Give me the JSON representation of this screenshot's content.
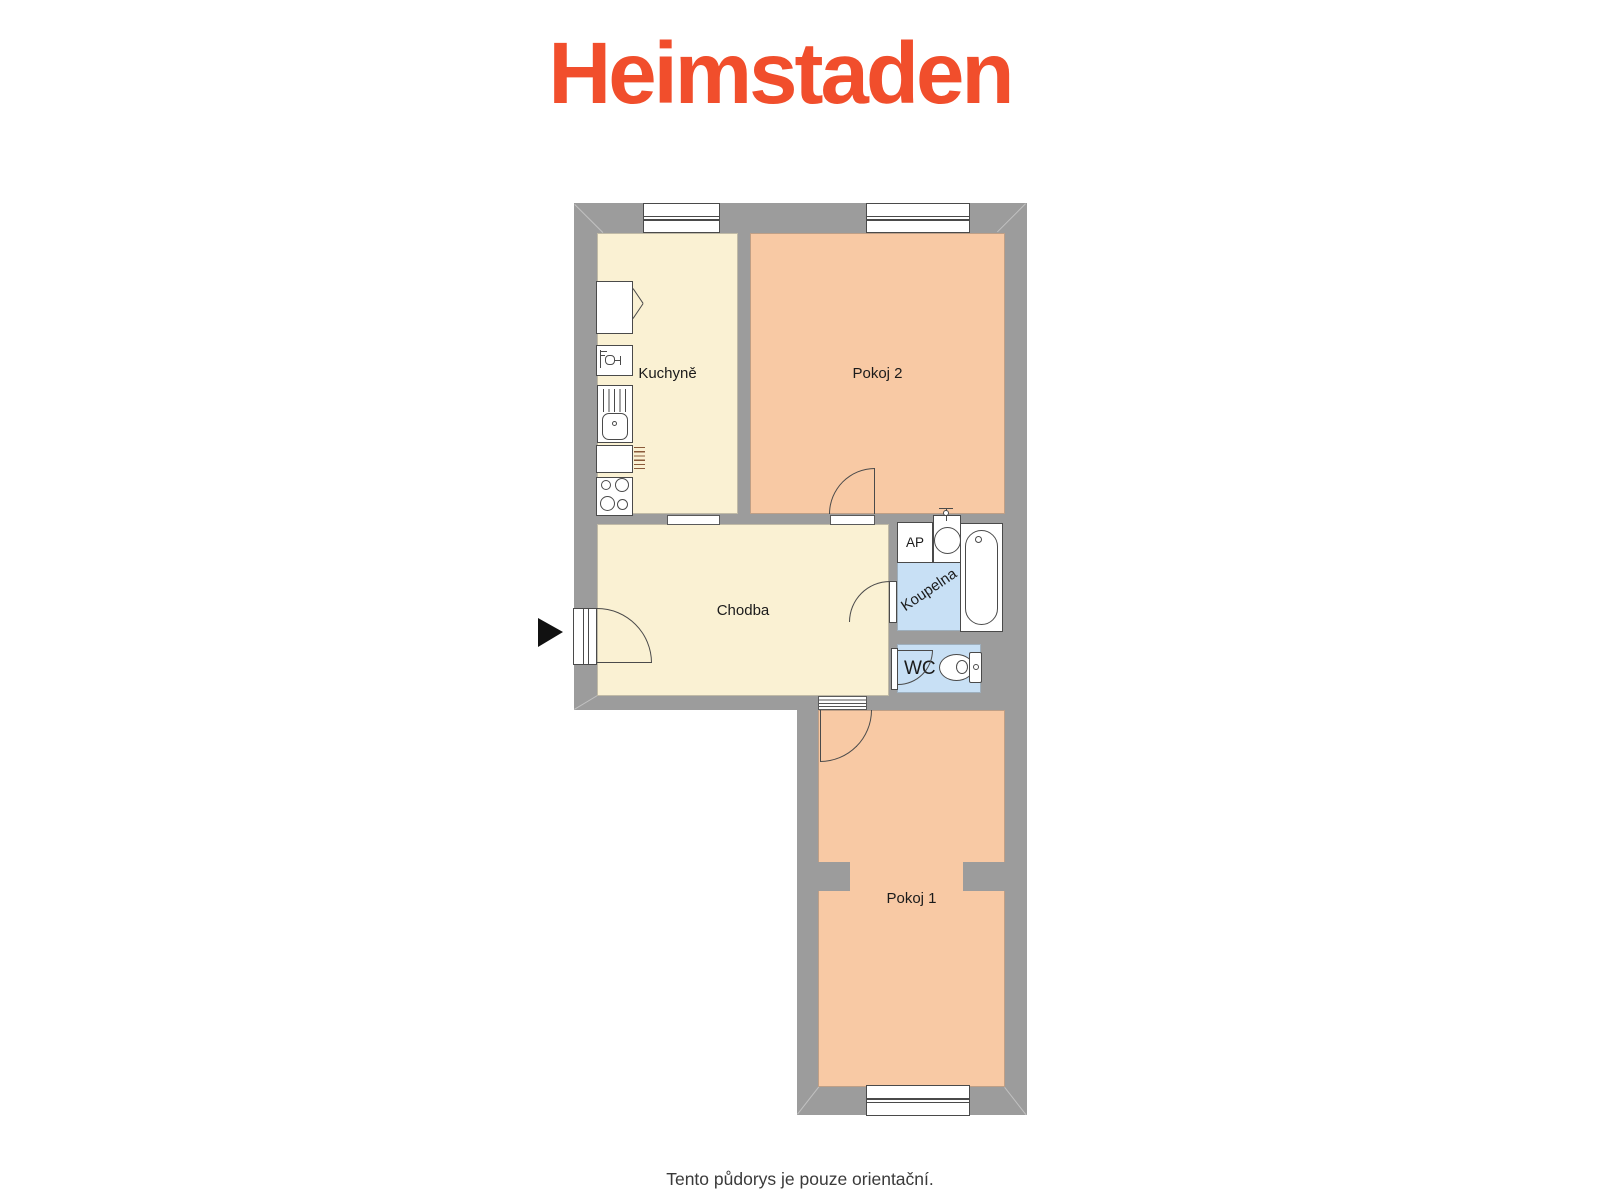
{
  "logo": {
    "text": "Heimstaden"
  },
  "caption": {
    "text": "Tento půdorys je pouze orientační."
  },
  "rooms": {
    "kuchyne": {
      "label": "Kuchyně"
    },
    "pokoj2": {
      "label": "Pokoj 2"
    },
    "chodba": {
      "label": "Chodba"
    },
    "koupelna": {
      "label": "Koupelna"
    },
    "wc": {
      "label": "WC"
    },
    "pokoj1": {
      "label": "Pokoj 1"
    },
    "washing_machine": {
      "label": "AP"
    }
  },
  "icons": {
    "entrance": "entrance-arrow",
    "kitchen_fixtures": [
      "fridge",
      "water-heater",
      "kitchen-sink",
      "counter",
      "stove"
    ],
    "bathroom_fixtures": [
      "washing-machine",
      "washbasin",
      "bathtub"
    ],
    "wc_fixtures": [
      "toilet"
    ],
    "openings": [
      "window",
      "door-swing",
      "door-frame",
      "threshold"
    ]
  },
  "colors": {
    "wall": "#9C9C9C",
    "room_cream": "#FAF1D3",
    "room_salmon": "#F8C9A4",
    "room_blue": "#C8E0F5",
    "logo_orange": "#F14E2C",
    "caption_gray": "#3A3A3A",
    "entrance_arrow": "#111111",
    "fixture_line": "#4A4A4A"
  }
}
